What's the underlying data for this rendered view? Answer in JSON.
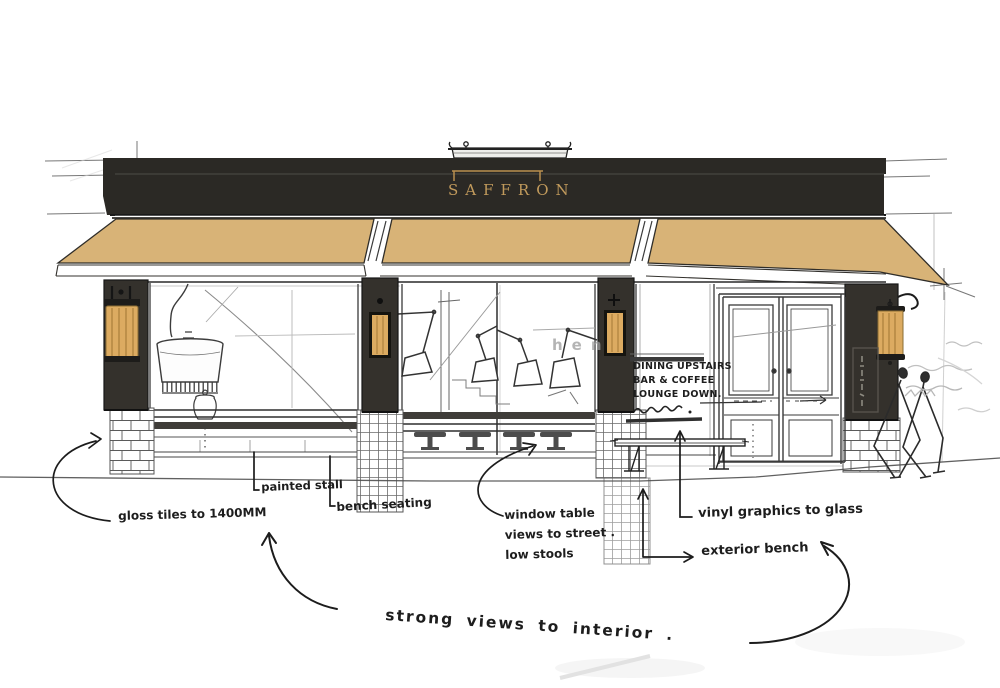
{
  "sign": {
    "label": "SAFFRON"
  },
  "glass_note": {
    "line1": "DINING UPSTAIRS",
    "line2": "BAR & COFFEE",
    "line3": "LOUNGE DOWN."
  },
  "ghost_text": "hen",
  "annotations": {
    "gloss_tiles": "gloss tiles to 1400MM",
    "painted_stall": "painted stall",
    "bench_seating": "bench seating",
    "window_table": {
      "l1": "window table",
      "l2": "views to street .",
      "l3": "low stools"
    },
    "vinyl_graphics": "vinyl graphics to glass",
    "exterior_bench": "exterior bench",
    "strong_views": "strong views to  interior ."
  },
  "colors": {
    "awning": "#d8b377",
    "fascia": "#2b2925",
    "pillar": "#34312c",
    "gold": "#c19a5c",
    "lamp": "#dcab61",
    "lampStripe": "#a97f3a",
    "ink": "#222222",
    "pencil": "#8a8a8a",
    "stall": "#3d3b37",
    "paper": "#ffffff"
  }
}
